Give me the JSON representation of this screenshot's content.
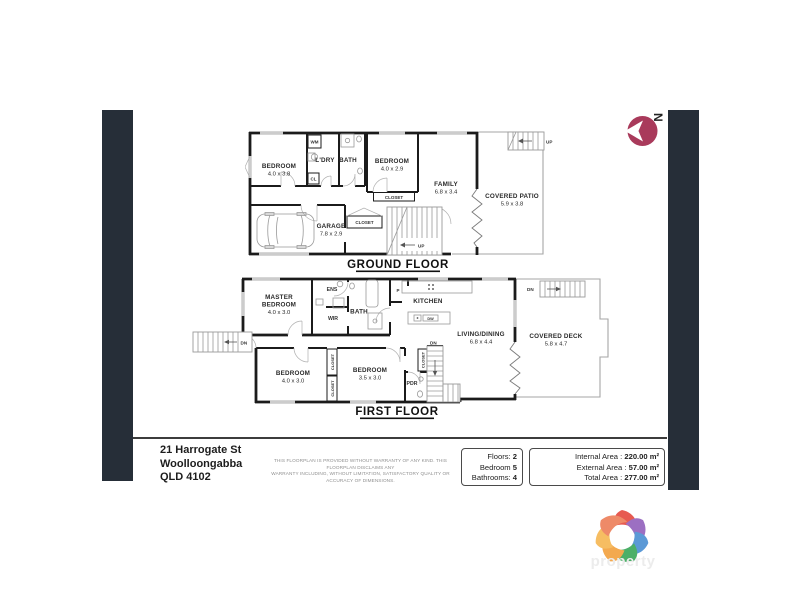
{
  "compass": {
    "north_letter": "N",
    "color": "#a93a5b"
  },
  "ground_floor": {
    "title": "GROUND FLOOR",
    "bedroom1": {
      "name": "BEDROOM",
      "dims": "4.0 x 3.8"
    },
    "ldry": {
      "name": "L'DRY"
    },
    "bath": {
      "name": "BATH"
    },
    "bedroom2": {
      "name": "BEDROOM",
      "dims": "4.0 x 2.9"
    },
    "family": {
      "name": "FAMILY",
      "dims": "6.8 x 3.4"
    },
    "patio": {
      "name": "COVERED PATIO",
      "dims": "5.9 x 3.8"
    },
    "garage": {
      "name": "GARAGE",
      "dims": "7.8 x 2.9"
    },
    "wm": "WM",
    "cl": "CL",
    "closet_bed2": "CLOSET",
    "closet_hall": "CLOSET",
    "up_main": "UP",
    "up_patio": "UP"
  },
  "first_floor": {
    "title": "FIRST FLOOR",
    "master": {
      "line1": "MASTER",
      "line2": "BEDROOM",
      "dims": "4.0 x 3.0"
    },
    "ens": "ENS",
    "wir": "WIR",
    "bath": "BATH",
    "pantry": "P",
    "kitchen": "KITCHEN",
    "dw": "DW",
    "living": {
      "name": "LIVING/DINING",
      "dims": "6.8 x 4.4"
    },
    "deck": {
      "name": "COVERED DECK",
      "dims": "5.8 x 4.7"
    },
    "bedroom2": {
      "name": "BEDROOM",
      "dims": "4.0 x 3.0"
    },
    "bedroom3": {
      "name": "BEDROOM",
      "dims": "3.5 x 3.0"
    },
    "pdr": "PDR",
    "closet_a": "CLOSET",
    "closet_b": "CLOSET",
    "closet_c": "CLOSET",
    "dn_left": "DN",
    "dn_mid": "DN",
    "dn_deck": "DN"
  },
  "footer": {
    "address_line1": "21 Harrogate St",
    "address_line2": "Woolloongabba",
    "address_line3": "QLD 4102",
    "disclaimer_line1": "THIS FLOORPLAN IS PROVIDED WITHOUT WARRANTY OF ANY KIND. THIS FLOORPLAN DISCLAIMS ANY",
    "disclaimer_line2": "WARRANTY INCLUDING, WITHOUT LIMITATION, SATISFACTORY QUALITY OR ACCURACY OF DIMENSIONS.",
    "stats": {
      "floors_label": "Floors:",
      "floors_value": "2",
      "bedroom_label": "Bedroom",
      "bedroom_value": "5",
      "bathrooms_label": "Bathrooms:",
      "bathrooms_value": "4"
    },
    "areas": {
      "internal_label": "Internal Area :",
      "internal_value": "220.00 m²",
      "external_label": "External Area :",
      "external_value": "57.00 m²",
      "total_label": "Total Area :",
      "total_value": "277.00 m²"
    }
  },
  "watermark": {
    "text": "property"
  }
}
